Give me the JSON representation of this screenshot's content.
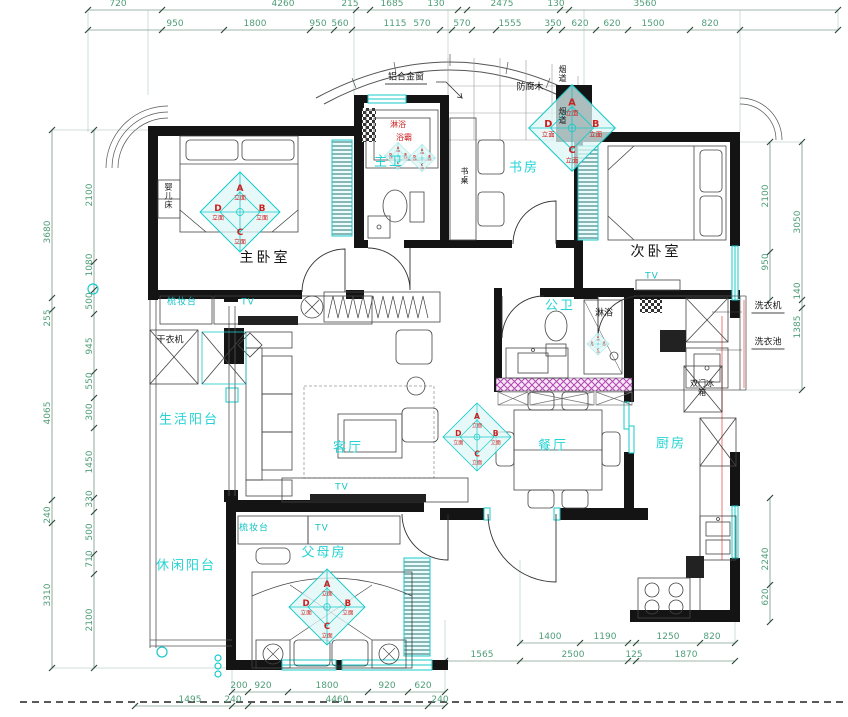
{
  "drawing": {
    "type": "apartment-floor-plan",
    "units": "mm"
  },
  "colors": {
    "wall": "#141414",
    "dim_text": "#4f9d78",
    "accent_cyan": "#19c9c9",
    "tag_red": "#cc2020",
    "hatch_magenta": "#b244b2"
  },
  "elev": {
    "a": "A",
    "b": "B",
    "c": "C",
    "d": "D",
    "code": "立面"
  },
  "rooms": [
    "主卧室",
    "次卧室",
    "主卫",
    "书房",
    "公卫",
    "客厅",
    "餐厅",
    "厨房",
    "生活阳台",
    "休闲阳台",
    "父母房"
  ],
  "text_labels": [
    {
      "name": "room-master-bedroom",
      "t": "主卧室",
      "x": 265,
      "y": 258,
      "c": "roomDark"
    },
    {
      "name": "room-second-bedroom",
      "t": "次卧室",
      "x": 656,
      "y": 252,
      "c": "roomDark"
    },
    {
      "name": "room-master-bath",
      "t": "主卫",
      "x": 389,
      "y": 162,
      "c": "room"
    },
    {
      "name": "room-study",
      "t": "书房",
      "x": 524,
      "y": 168,
      "c": "room"
    },
    {
      "name": "room-public-bath",
      "t": "公卫",
      "x": 560,
      "y": 306,
      "c": "room"
    },
    {
      "name": "room-living",
      "t": "客厅",
      "x": 348,
      "y": 448,
      "c": "room"
    },
    {
      "name": "room-dining",
      "t": "餐厅",
      "x": 553,
      "y": 446,
      "c": "room"
    },
    {
      "name": "room-kitchen",
      "t": "厨房",
      "x": 671,
      "y": 444,
      "c": "room"
    },
    {
      "name": "room-utility-balcony",
      "t": "生活阳台",
      "x": 189,
      "y": 420,
      "c": "room"
    },
    {
      "name": "room-leisure-balcony",
      "t": "休闲阳台",
      "x": 186,
      "y": 566,
      "c": "room"
    },
    {
      "name": "room-parents",
      "t": "父母房",
      "x": 324,
      "y": 553,
      "c": "room"
    },
    {
      "name": "label-aluminium-window",
      "t": "铝合金窗",
      "x": 406,
      "y": 79,
      "c": "small lead"
    },
    {
      "name": "label-deck-wood",
      "t": "防腐木",
      "x": 530,
      "y": 88,
      "c": "small"
    },
    {
      "name": "label-flue-top",
      "t": "烟道",
      "x": 562,
      "y": 74,
      "c": "tinyV"
    },
    {
      "name": "label-flue-mid",
      "t": "烟道",
      "x": 562,
      "y": 116,
      "c": "tinyV"
    },
    {
      "name": "label-desk",
      "t": "书桌",
      "x": 464,
      "y": 176,
      "c": "tinyV"
    },
    {
      "name": "label-baby-crib",
      "t": "婴儿床",
      "x": 168,
      "y": 196,
      "c": "tinyV"
    },
    {
      "name": "label-dryer",
      "t": "干衣机",
      "x": 170,
      "y": 341,
      "c": "small"
    },
    {
      "name": "label-shower-public",
      "t": "淋浴",
      "x": 604,
      "y": 314,
      "c": "small"
    },
    {
      "name": "label-fridge",
      "t": "双门冰箱",
      "x": 702,
      "y": 388,
      "c": "tiny"
    },
    {
      "name": "label-washing-machine",
      "t": "洗衣机",
      "x": 768,
      "y": 308,
      "c": "small lead"
    },
    {
      "name": "label-laundry-sink",
      "t": "洗衣池",
      "x": 768,
      "y": 344,
      "c": "small lead"
    },
    {
      "name": "label-dresser-master",
      "t": "梳妆台",
      "x": 182,
      "y": 303,
      "c": "cyanSmall"
    },
    {
      "name": "label-tv-master",
      "t": "TV",
      "x": 248,
      "y": 303,
      "c": "cyanSmall"
    },
    {
      "name": "label-tv-second",
      "t": "TV",
      "x": 652,
      "y": 277,
      "c": "cyanSmall"
    },
    {
      "name": "label-tv-living",
      "t": "TV",
      "x": 342,
      "y": 488,
      "c": "cyanSmall"
    },
    {
      "name": "label-dresser-parents",
      "t": "梳妆台",
      "x": 254,
      "y": 529,
      "c": "cyanSmall"
    },
    {
      "name": "label-tv-parents",
      "t": "TV",
      "x": 322,
      "y": 529,
      "c": "cyanSmall"
    },
    {
      "name": "label-shower-master",
      "t": "淋浴",
      "x": 398,
      "y": 125,
      "c": "red"
    },
    {
      "name": "label-bath-heater",
      "t": "浴霸",
      "x": 404,
      "y": 138,
      "c": "red"
    }
  ],
  "dim_labels": [
    {
      "t": "720",
      "x": 118,
      "y": 4
    },
    {
      "t": "4260",
      "x": 283,
      "y": 4
    },
    {
      "t": "215",
      "x": 350,
      "y": 4
    },
    {
      "t": "1685",
      "x": 392,
      "y": 4
    },
    {
      "t": "130",
      "x": 436,
      "y": 4
    },
    {
      "t": "2475",
      "x": 502,
      "y": 4
    },
    {
      "t": "130",
      "x": 556,
      "y": 4
    },
    {
      "t": "3560",
      "x": 645,
      "y": 4
    },
    {
      "t": "950",
      "x": 175,
      "y": 24
    },
    {
      "t": "1800",
      "x": 255,
      "y": 24
    },
    {
      "t": "950",
      "x": 318,
      "y": 24
    },
    {
      "t": "560",
      "x": 340,
      "y": 24
    },
    {
      "t": "1115",
      "x": 395,
      "y": 24
    },
    {
      "t": "570",
      "x": 422,
      "y": 24
    },
    {
      "t": "570",
      "x": 462,
      "y": 24
    },
    {
      "t": "1555",
      "x": 510,
      "y": 24
    },
    {
      "t": "350",
      "x": 553,
      "y": 24
    },
    {
      "t": "620",
      "x": 580,
      "y": 24
    },
    {
      "t": "620",
      "x": 612,
      "y": 24
    },
    {
      "t": "1500",
      "x": 653,
      "y": 24
    },
    {
      "t": "820",
      "x": 710,
      "y": 24
    },
    {
      "t": "3680",
      "x": 48,
      "y": 232,
      "v": 1
    },
    {
      "t": "255",
      "x": 48,
      "y": 318,
      "v": 1
    },
    {
      "t": "4065",
      "x": 48,
      "y": 413,
      "v": 1
    },
    {
      "t": "240",
      "x": 48,
      "y": 515,
      "v": 1
    },
    {
      "t": "3310",
      "x": 48,
      "y": 595,
      "v": 1
    },
    {
      "t": "2100",
      "x": 90,
      "y": 195,
      "v": 1
    },
    {
      "t": "1080",
      "x": 90,
      "y": 265,
      "v": 1
    },
    {
      "t": "500",
      "x": 90,
      "y": 301,
      "v": 1
    },
    {
      "t": "945",
      "x": 90,
      "y": 346,
      "v": 1
    },
    {
      "t": "550",
      "x": 90,
      "y": 381,
      "v": 1
    },
    {
      "t": "300",
      "x": 90,
      "y": 412,
      "v": 1
    },
    {
      "t": "1450",
      "x": 90,
      "y": 462,
      "v": 1
    },
    {
      "t": "330",
      "x": 90,
      "y": 499,
      "v": 1
    },
    {
      "t": "500",
      "x": 90,
      "y": 532,
      "v": 1
    },
    {
      "t": "710",
      "x": 90,
      "y": 559,
      "v": 1
    },
    {
      "t": "2100",
      "x": 90,
      "y": 620,
      "v": 1
    },
    {
      "t": "2100",
      "x": 766,
      "y": 196,
      "v": 1
    },
    {
      "t": "950",
      "x": 766,
      "y": 262,
      "v": 1
    },
    {
      "t": "2240",
      "x": 766,
      "y": 559,
      "v": 1
    },
    {
      "t": "620",
      "x": 766,
      "y": 597,
      "v": 1
    },
    {
      "t": "3050",
      "x": 798,
      "y": 222,
      "v": 1
    },
    {
      "t": "140",
      "x": 798,
      "y": 291,
      "v": 1
    },
    {
      "t": "1385",
      "x": 798,
      "y": 327,
      "v": 1
    },
    {
      "t": "200",
      "x": 239,
      "y": 686
    },
    {
      "t": "920",
      "x": 263,
      "y": 686
    },
    {
      "t": "1800",
      "x": 327,
      "y": 686
    },
    {
      "t": "920",
      "x": 387,
      "y": 686
    },
    {
      "t": "620",
      "x": 423,
      "y": 686
    },
    {
      "t": "1495",
      "x": 190,
      "y": 700
    },
    {
      "t": "240",
      "x": 233,
      "y": 700
    },
    {
      "t": "4460",
      "x": 337,
      "y": 700
    },
    {
      "t": "240",
      "x": 440,
      "y": 700
    },
    {
      "t": "1400",
      "x": 550,
      "y": 637
    },
    {
      "t": "1190",
      "x": 605,
      "y": 637
    },
    {
      "t": "1250",
      "x": 668,
      "y": 637
    },
    {
      "t": "820",
      "x": 712,
      "y": 637
    },
    {
      "t": "1565",
      "x": 482,
      "y": 655
    },
    {
      "t": "2500",
      "x": 573,
      "y": 655
    },
    {
      "t": "125",
      "x": 634,
      "y": 655
    },
    {
      "t": "1870",
      "x": 686,
      "y": 655
    }
  ]
}
